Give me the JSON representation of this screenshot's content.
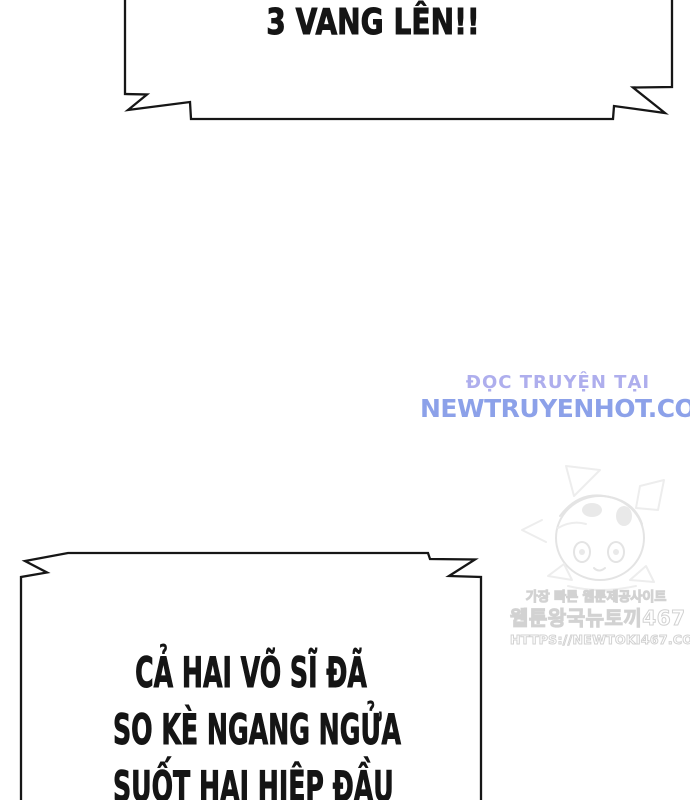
{
  "colors": {
    "ink": "#161616",
    "text": "#151515",
    "wm_lavender": "#aeaeed",
    "wm_blue": "#8ca1e9",
    "wm_gray": "#d2d2d2"
  },
  "top_bubble": {
    "text": "3 VANG LÊN!!"
  },
  "bottom_bubble": {
    "lines": [
      "CẢ HAI VÕ SĨ ĐÃ",
      "SO KÈ NGANG NGỬA",
      "SUỐT HAI HIỆP ĐẦU"
    ]
  },
  "site_watermark": {
    "line1": "ĐỌC TRUYỆN TẠI",
    "line2": "NEWTRUYENHOT.COM"
  },
  "korean_watermark": {
    "line1": "가장 빠른 웹툰제공사이트",
    "line2": "웹툰왕국뉴토끼467",
    "line3": "HTTPS://NEWTOKI467.COM"
  }
}
